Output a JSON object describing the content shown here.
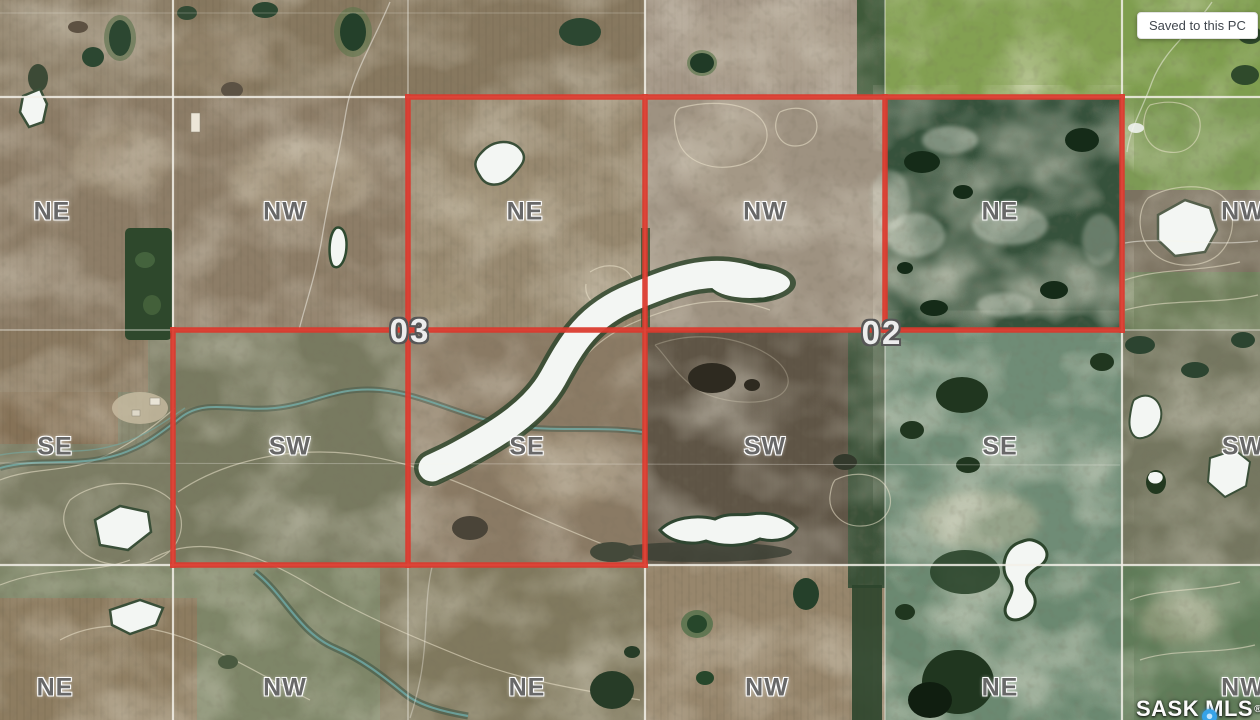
{
  "map": {
    "quarter_labels": [
      {
        "text": "NE",
        "x": 52,
        "y": 212
      },
      {
        "text": "NW",
        "x": 285,
        "y": 212
      },
      {
        "text": "NE",
        "x": 525,
        "y": 212
      },
      {
        "text": "NW",
        "x": 765,
        "y": 212
      },
      {
        "text": "NE",
        "x": 1000,
        "y": 212
      },
      {
        "text": "NW",
        "x": 1243,
        "y": 212
      },
      {
        "text": "SE",
        "x": 55,
        "y": 447
      },
      {
        "text": "SW",
        "x": 290,
        "y": 447
      },
      {
        "text": "SE",
        "x": 527,
        "y": 447
      },
      {
        "text": "SW",
        "x": 765,
        "y": 447
      },
      {
        "text": "SE",
        "x": 1000,
        "y": 447
      },
      {
        "text": "SW",
        "x": 1243,
        "y": 447
      },
      {
        "text": "NE",
        "x": 55,
        "y": 688
      },
      {
        "text": "NW",
        "x": 285,
        "y": 688
      },
      {
        "text": "NE",
        "x": 527,
        "y": 688
      },
      {
        "text": "NW",
        "x": 767,
        "y": 688
      },
      {
        "text": "NE",
        "x": 1000,
        "y": 688
      },
      {
        "text": "NW",
        "x": 1243,
        "y": 688
      }
    ],
    "section_numbers": [
      {
        "text": "03",
        "x": 410,
        "y": 331
      },
      {
        "text": "02",
        "x": 882,
        "y": 333
      }
    ],
    "colors": {
      "parcel_outline": "#dc392d",
      "grid_line": "#f2f0e8",
      "quarter_label": "#686868",
      "water_white": "#f3f6f3"
    }
  },
  "tooltip": {
    "text": "Saved to this PC"
  },
  "watermark": {
    "prefix": "SASK",
    "suffix": "MLS",
    "registered": "®",
    "pin_icon": "map-pin-icon",
    "pin_color": "#36a3e8"
  }
}
